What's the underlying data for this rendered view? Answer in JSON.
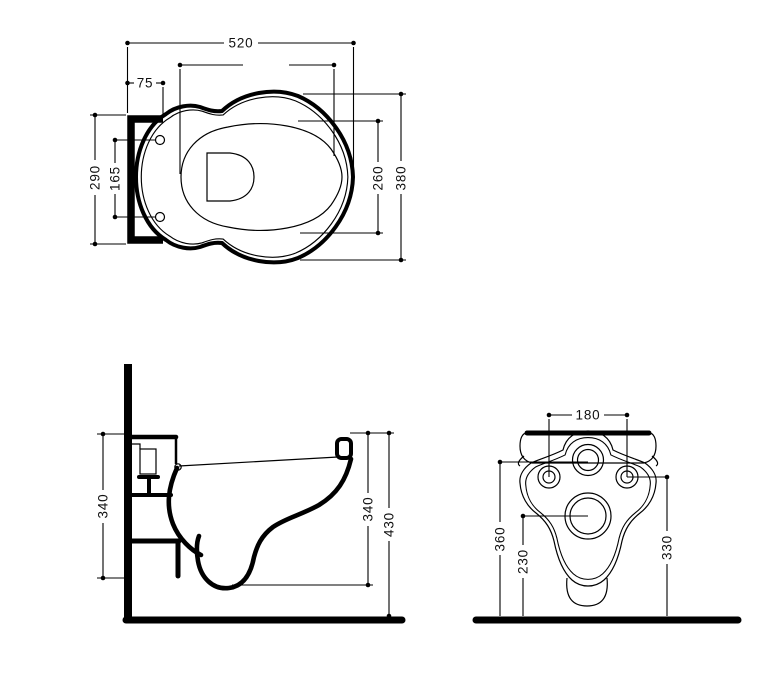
{
  "drawing": {
    "subject": "wall-hung-toilet-technical-drawing",
    "colors": {
      "line": "#000000",
      "background": "#ffffff"
    },
    "views": {
      "top": {
        "label": "plan-view",
        "dims": {
          "overall_length": "520",
          "hole_offset": "75",
          "mount_depth": "290",
          "hole_spacing": "165",
          "bowl_inner_width": "260",
          "bowl_outer_width": "380"
        }
      },
      "side": {
        "label": "side-view",
        "dims": {
          "mount_height": "340",
          "bowl_height": "340",
          "total_height": "430"
        }
      },
      "front": {
        "label": "front-view",
        "dims": {
          "fixing_hole_spacing": "180",
          "inlet_height": "360",
          "outlet_height": "230",
          "fixing_hole_height": "330"
        }
      }
    }
  }
}
